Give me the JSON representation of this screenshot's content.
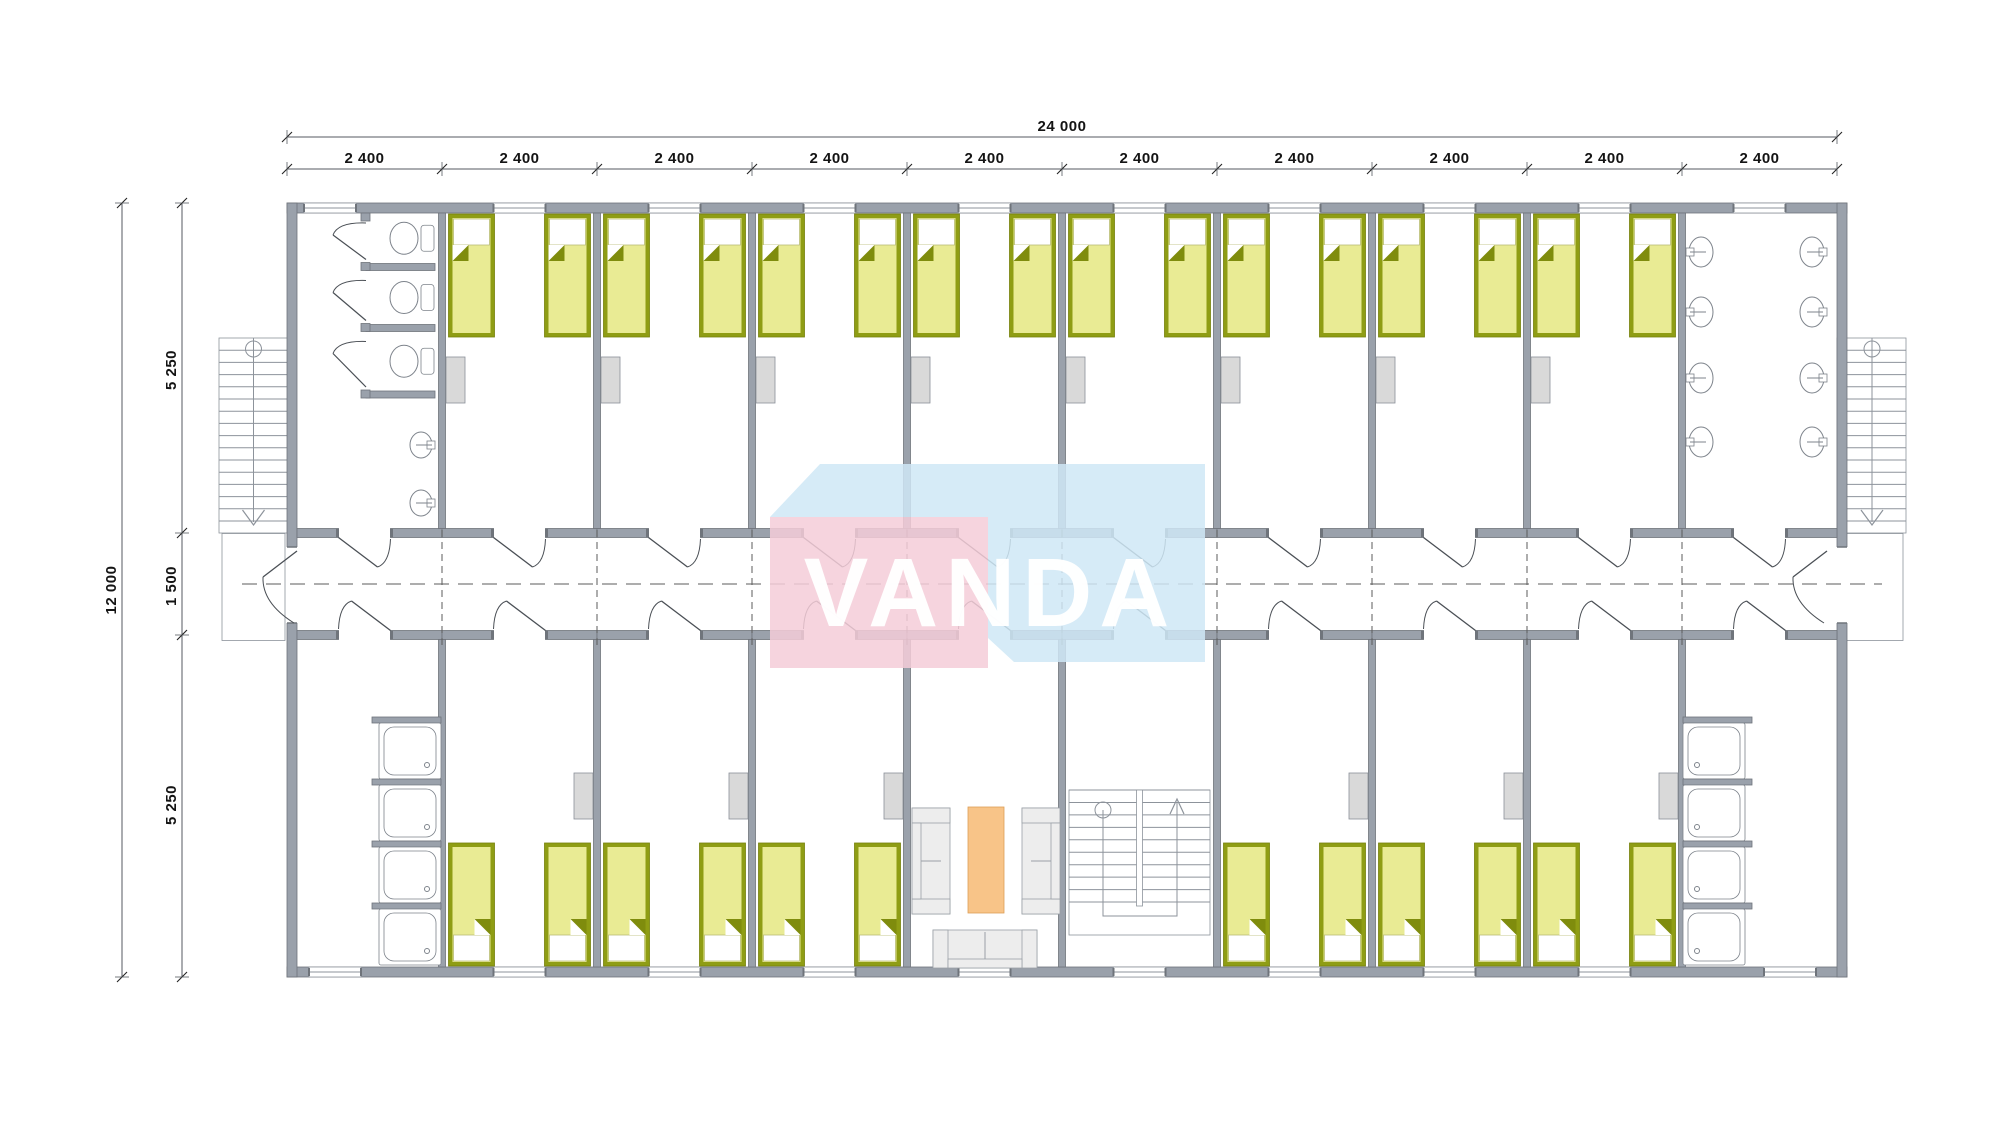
{
  "dimensions": {
    "top": {
      "total": "24 000",
      "segments": [
        "2 400",
        "2 400",
        "2 400",
        "2 400",
        "2 400",
        "2 400",
        "2 400",
        "2 400",
        "2 400",
        "2 400"
      ]
    },
    "left": {
      "total": "12 000",
      "segments": [
        "5 250",
        "1 500",
        "5 250"
      ]
    }
  },
  "watermark": {
    "text": "VANDA",
    "front_color": "#f5cdd8",
    "top_color": "#cfe7f6",
    "text_color": "#ffffff",
    "front_opacity": "0.85",
    "top_opacity": "0.85"
  },
  "palette": {
    "wall": "#9aa1ab",
    "wall_dark": "#6f747b",
    "line": "#8d939b",
    "door": "#4a4f55",
    "axis": "#5b5b5b",
    "dim_line": "#555a60",
    "dim_text": "#141414",
    "bed_frame": "#8f9d14",
    "bed_fill": "#e9eb94",
    "bed_fold": "#7f8c0d",
    "pillow": "#ffffff",
    "locker": "#d9d9d9",
    "locker_edge": "#8a9098",
    "fixture": "#ffffff",
    "fixture_edge": "#7d838b",
    "sofa": "#ededed",
    "sofa_edge": "#9aa0a7",
    "table": "#f8c488",
    "table_edge": "#dd9f58"
  },
  "inventory": {
    "bays": 10,
    "bedrooms": 14,
    "beds": 28,
    "wc_stalls": 3,
    "toilets": 3,
    "urinals": 2,
    "wash_basins": 8,
    "showers": 8,
    "sofas": 3,
    "coffee_tables": 1,
    "external_stairs": 2,
    "internal_stairs": 1,
    "entry_doors": 2,
    "room_doors": 20,
    "windows": 20
  }
}
